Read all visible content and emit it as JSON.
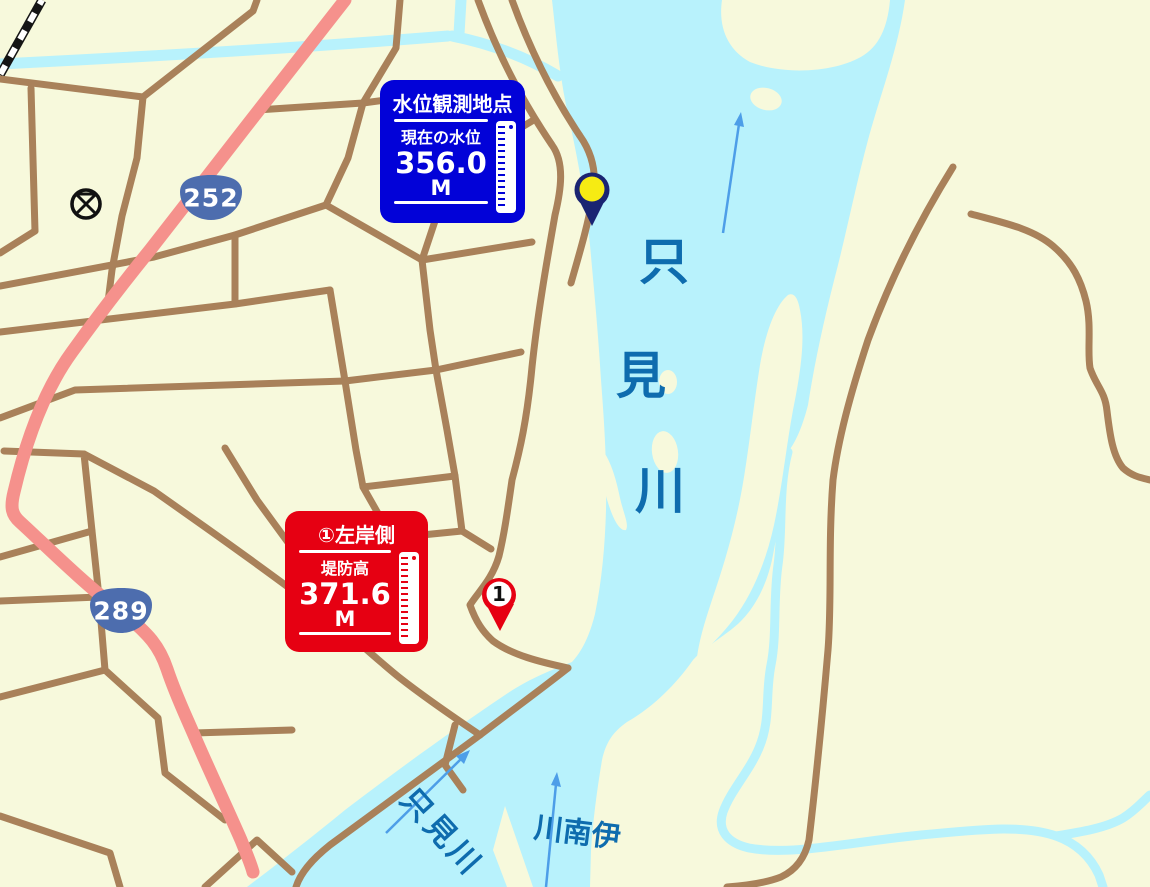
{
  "map": {
    "colors": {
      "land": "#F7F9DC",
      "water": "#B8F2FC",
      "road_brown": "#A9815A",
      "road_pink": "#F5918C",
      "railway_black": "#151515",
      "river_label_blue": "#0E6CAE",
      "flow_arrow_blue": "#4D9EE8",
      "observation_panel_blue": "#0202D8",
      "levee_panel_red": "#E60012",
      "route_shield_blue": "#4D6DAE",
      "observation_pin_navy": "#1A2472",
      "observation_pin_yellow": "#F6EB13",
      "levee_pin_red": "#E60012"
    },
    "rivers": {
      "main": {
        "name": "只見川",
        "chars": [
          "只",
          "見",
          "川"
        ]
      },
      "tributary_sw": {
        "name": "只見川"
      },
      "tributary_s": {
        "name": "伊南川"
      }
    },
    "route_shields": [
      {
        "number": "252"
      },
      {
        "number": "289"
      }
    ],
    "map_symbols": [
      {
        "icon": "police-station-icon"
      },
      {
        "icon": "railway-line"
      }
    ],
    "markers": {
      "observation_pin": {
        "type": "water-level-observation-point"
      },
      "levee_pin": {
        "label": "1"
      }
    },
    "panels": {
      "observation": {
        "title": "水位観測地点",
        "label": "現在の水位",
        "value": "356.0",
        "unit": "M"
      },
      "levee": {
        "title": "①左岸側",
        "label": "堤防高",
        "value": "371.6",
        "unit": "M"
      }
    }
  }
}
